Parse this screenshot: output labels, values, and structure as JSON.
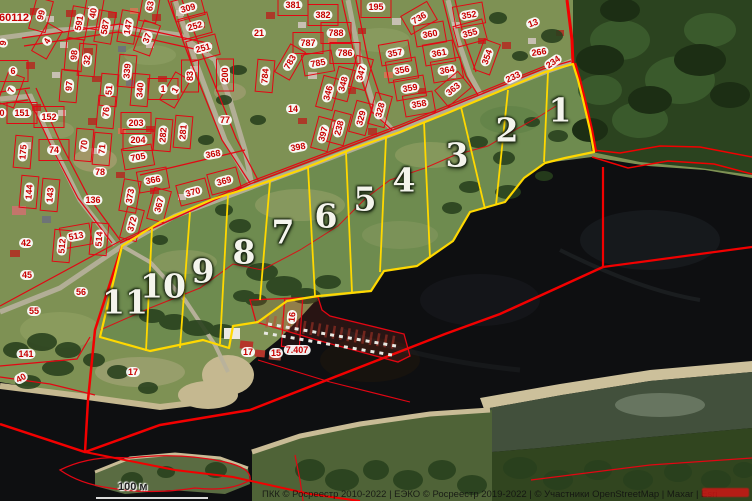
{
  "map": {
    "scale_label": "100 м",
    "attribution": "ПКК © Росреестр 2010-2022 | ЕЭКО © Росреестр 2019-2022 | © Участники OpenStreetMap | Maxar | Esri",
    "colors": {
      "cadastral_line": "#e30613",
      "highlight_outline": "#ffd800",
      "label_text": "#c80000",
      "parcel_number_text": "#f4f4ec",
      "water": "#0e0f11",
      "forest": "#2b431f",
      "watermark": "#d61414"
    },
    "parcels": [
      {
        "n": "1",
        "x": 560,
        "y": 110
      },
      {
        "n": "2",
        "x": 507,
        "y": 130
      },
      {
        "n": "3",
        "x": 457,
        "y": 155
      },
      {
        "n": "4",
        "x": 404,
        "y": 180
      },
      {
        "n": "5",
        "x": 365,
        "y": 199
      },
      {
        "n": "6",
        "x": 326,
        "y": 216
      },
      {
        "n": "7",
        "x": 283,
        "y": 232
      },
      {
        "n": "8",
        "x": 244,
        "y": 252
      },
      {
        "n": "9",
        "x": 203,
        "y": 271
      },
      {
        "n": "10",
        "x": 163,
        "y": 286
      },
      {
        "n": "11",
        "x": 125,
        "y": 302
      }
    ],
    "labels": [
      {
        "t": "60112",
        "x": 14,
        "y": 18,
        "r": 0,
        "c": false,
        "fs": 11
      },
      {
        "t": "9",
        "x": 3,
        "y": 43,
        "r": -80,
        "c": false
      },
      {
        "t": "99",
        "x": 41,
        "y": 15,
        "r": -75
      },
      {
        "t": "591",
        "x": 79,
        "y": 23,
        "r": -80
      },
      {
        "t": "40",
        "x": 93,
        "y": 13,
        "r": -80
      },
      {
        "t": "587",
        "x": 105,
        "y": 27,
        "r": -80
      },
      {
        "t": "147",
        "x": 128,
        "y": 27,
        "r": -80
      },
      {
        "t": "63",
        "x": 150,
        "y": 6,
        "r": -80
      },
      {
        "t": "37",
        "x": 147,
        "y": 38,
        "r": -70
      },
      {
        "t": "309",
        "x": 188,
        "y": 8,
        "r": -15
      },
      {
        "t": "252",
        "x": 195,
        "y": 26,
        "r": -15
      },
      {
        "t": "251",
        "x": 203,
        "y": 48,
        "r": -15
      },
      {
        "t": "4",
        "x": 47,
        "y": 41,
        "r": -60
      },
      {
        "t": "98",
        "x": 74,
        "y": 55,
        "r": -85
      },
      {
        "t": "32",
        "x": 87,
        "y": 60,
        "r": -85
      },
      {
        "t": "6",
        "x": 13,
        "y": 71,
        "r": 0
      },
      {
        "t": "7",
        "x": 11,
        "y": 90,
        "r": -70
      },
      {
        "t": "97",
        "x": 69,
        "y": 86,
        "r": -85
      },
      {
        "t": "51",
        "x": 109,
        "y": 90,
        "r": -85
      },
      {
        "t": "339",
        "x": 127,
        "y": 71,
        "r": -85
      },
      {
        "t": "340",
        "x": 140,
        "y": 90,
        "r": -85
      },
      {
        "t": "83",
        "x": 190,
        "y": 76,
        "r": -90
      },
      {
        "t": "200",
        "x": 225,
        "y": 75,
        "r": -90
      },
      {
        "t": "1",
        "x": 163,
        "y": 89,
        "r": 0
      },
      {
        "t": "1",
        "x": 175,
        "y": 90,
        "r": -60
      },
      {
        "t": "0",
        "x": 2,
        "y": 113,
        "r": 0,
        "c": false
      },
      {
        "t": "151",
        "x": 22,
        "y": 113
      },
      {
        "t": "152",
        "x": 49,
        "y": 117
      },
      {
        "t": "76",
        "x": 106,
        "y": 112,
        "r": -85
      },
      {
        "t": "70",
        "x": 84,
        "y": 145,
        "r": -85
      },
      {
        "t": "71",
        "x": 102,
        "y": 149,
        "r": -85
      },
      {
        "t": "203",
        "x": 136,
        "y": 123
      },
      {
        "t": "204",
        "x": 138,
        "y": 140
      },
      {
        "t": "282",
        "x": 163,
        "y": 135,
        "r": -85
      },
      {
        "t": "281",
        "x": 183,
        "y": 132,
        "r": -85
      },
      {
        "t": "77",
        "x": 225,
        "y": 120,
        "c": false
      },
      {
        "t": "175",
        "x": 23,
        "y": 152,
        "r": -85
      },
      {
        "t": "74",
        "x": 54,
        "y": 150
      },
      {
        "t": "705",
        "x": 138,
        "y": 157,
        "r": -10
      },
      {
        "t": "368",
        "x": 213,
        "y": 154,
        "r": -10,
        "c": false
      },
      {
        "t": "381",
        "x": 293,
        "y": 5
      },
      {
        "t": "382",
        "x": 323,
        "y": 15
      },
      {
        "t": "195",
        "x": 376,
        "y": 7
      },
      {
        "t": "736",
        "x": 419,
        "y": 18,
        "r": -30
      },
      {
        "t": "352",
        "x": 469,
        "y": 15,
        "r": -10
      },
      {
        "t": "21",
        "x": 259,
        "y": 33,
        "c": false
      },
      {
        "t": "788",
        "x": 336,
        "y": 33
      },
      {
        "t": "787",
        "x": 308,
        "y": 43
      },
      {
        "t": "786",
        "x": 345,
        "y": 53
      },
      {
        "t": "783",
        "x": 290,
        "y": 62,
        "r": -60
      },
      {
        "t": "785",
        "x": 318,
        "y": 63,
        "r": -10
      },
      {
        "t": "360",
        "x": 430,
        "y": 34,
        "r": -10
      },
      {
        "t": "355",
        "x": 470,
        "y": 33,
        "r": -15
      },
      {
        "t": "357",
        "x": 395,
        "y": 53,
        "r": -10
      },
      {
        "t": "361",
        "x": 439,
        "y": 53,
        "r": -10
      },
      {
        "t": "354",
        "x": 487,
        "y": 57,
        "r": -70
      },
      {
        "t": "784",
        "x": 265,
        "y": 76,
        "r": -85
      },
      {
        "t": "347",
        "x": 361,
        "y": 73,
        "r": -75
      },
      {
        "t": "356",
        "x": 402,
        "y": 70,
        "r": -10
      },
      {
        "t": "364",
        "x": 447,
        "y": 70,
        "r": -10
      },
      {
        "t": "346",
        "x": 328,
        "y": 93,
        "r": -75
      },
      {
        "t": "348",
        "x": 343,
        "y": 84,
        "r": -75
      },
      {
        "t": "359",
        "x": 410,
        "y": 88,
        "r": -10
      },
      {
        "t": "363",
        "x": 453,
        "y": 89,
        "r": -40
      },
      {
        "t": "14",
        "x": 293,
        "y": 109,
        "c": false
      },
      {
        "t": "328",
        "x": 380,
        "y": 110,
        "r": -75
      },
      {
        "t": "358",
        "x": 419,
        "y": 104,
        "r": -10
      },
      {
        "t": "329",
        "x": 361,
        "y": 118,
        "r": -75
      },
      {
        "t": "238",
        "x": 339,
        "y": 128,
        "r": -75
      },
      {
        "t": "397",
        "x": 323,
        "y": 134,
        "r": -75
      },
      {
        "t": "398",
        "x": 298,
        "y": 147,
        "r": -10,
        "c": false
      },
      {
        "t": "13",
        "x": 533,
        "y": 23,
        "r": -20,
        "c": false
      },
      {
        "t": "266",
        "x": 539,
        "y": 52,
        "r": -8,
        "c": false
      },
      {
        "t": "234",
        "x": 553,
        "y": 62,
        "r": -35,
        "c": false
      },
      {
        "t": "233",
        "x": 513,
        "y": 77,
        "r": -25,
        "c": false
      },
      {
        "t": "144",
        "x": 29,
        "y": 192,
        "r": -85
      },
      {
        "t": "143",
        "x": 50,
        "y": 195,
        "r": -85
      },
      {
        "t": "78",
        "x": 100,
        "y": 172,
        "c": false
      },
      {
        "t": "136",
        "x": 93,
        "y": 200,
        "c": false
      },
      {
        "t": "366",
        "x": 153,
        "y": 180,
        "r": -10
      },
      {
        "t": "373",
        "x": 130,
        "y": 196,
        "r": -80
      },
      {
        "t": "369",
        "x": 224,
        "y": 181,
        "r": -15
      },
      {
        "t": "370",
        "x": 193,
        "y": 192,
        "r": -15
      },
      {
        "t": "367",
        "x": 159,
        "y": 205,
        "r": -75
      },
      {
        "t": "372",
        "x": 132,
        "y": 224,
        "r": -75
      },
      {
        "t": "42",
        "x": 26,
        "y": 243,
        "c": false
      },
      {
        "t": "513",
        "x": 76,
        "y": 236,
        "r": -10
      },
      {
        "t": "512",
        "x": 62,
        "y": 246,
        "r": -85
      },
      {
        "t": "514",
        "x": 99,
        "y": 239,
        "r": -85
      },
      {
        "t": "45",
        "x": 27,
        "y": 275,
        "c": false
      },
      {
        "t": "56",
        "x": 81,
        "y": 292,
        "c": false
      },
      {
        "t": "55",
        "x": 34,
        "y": 311,
        "c": false
      },
      {
        "t": "16",
        "x": 292,
        "y": 317,
        "r": -85,
        "c": false
      },
      {
        "t": "17",
        "x": 248,
        "y": 352,
        "c": false
      },
      {
        "t": "15",
        "x": 276,
        "y": 353,
        "c": false
      },
      {
        "t": "7.407",
        "x": 297,
        "y": 350,
        "c": false
      },
      {
        "t": "141",
        "x": 26,
        "y": 354,
        "c": false
      },
      {
        "t": "40",
        "x": 21,
        "y": 378,
        "r": -30,
        "c": false
      },
      {
        "t": "17",
        "x": 133,
        "y": 372,
        "c": false
      }
    ]
  }
}
